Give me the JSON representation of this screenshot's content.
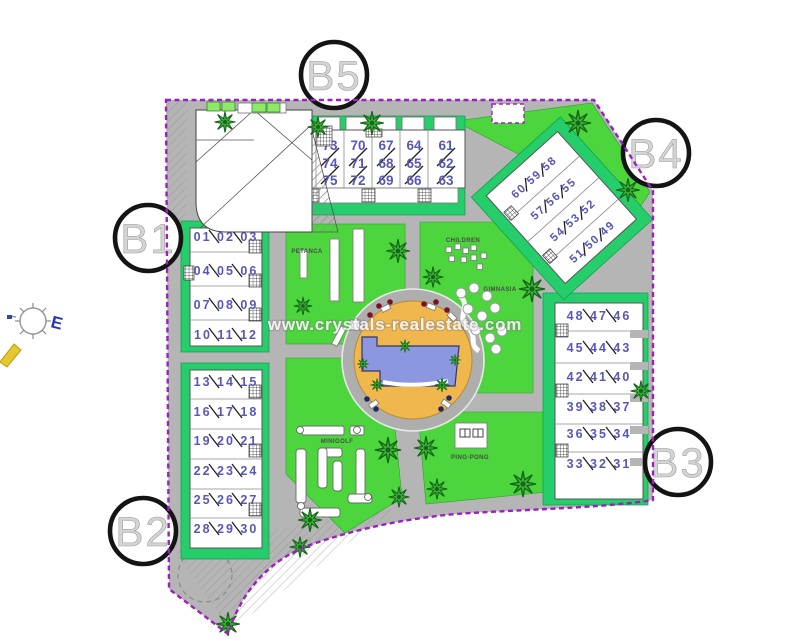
{
  "site": {
    "watermark": "www.crystals-realestate.com",
    "compass_label": "E",
    "colors": {
      "boundary": "#9b1fc1",
      "lawn": "#4cd53c",
      "building_surround": "#26cd6b",
      "paving": "#b5b5b5",
      "pool_deck": "#efb74e",
      "pool_water": "#8b97de",
      "unit_numbers": "#5757b8"
    }
  },
  "amenities": {
    "petanca": "PETANCA",
    "children": "CHILDREN",
    "gimnasia": "GIMNASIA",
    "minigolf": "MINIGOLF",
    "pingpong": "PING-PONG"
  },
  "blocks": {
    "b1": {
      "label": "B1",
      "rows": [
        "01 02 03",
        "04 05 06",
        "07 08 09",
        "10 11 12"
      ]
    },
    "b2": {
      "label": "B2",
      "rows": [
        "13 14 15",
        "16 17 18",
        "19 20 21",
        "22 23 24",
        "25 26 27",
        "28 29 30"
      ]
    },
    "b3": {
      "label": "B3",
      "rows": [
        "48 47 46",
        "45 44 43",
        "42 41 40",
        "39 38 37",
        "36 35 34",
        "33 32 31"
      ]
    },
    "b4": {
      "label": "B4",
      "rows": [
        "60 59 58",
        "57 56 55",
        "54 53 52",
        "51 50 49"
      ]
    },
    "b5": {
      "label": "B5",
      "columns": [
        [
          "76",
          "77",
          "78"
        ],
        [
          "73",
          "74",
          "75"
        ],
        [
          "70",
          "71",
          "72"
        ],
        [
          "67",
          "68",
          "69"
        ],
        [
          "64",
          "65",
          "66"
        ],
        [
          "61",
          "62",
          "63"
        ]
      ]
    }
  }
}
